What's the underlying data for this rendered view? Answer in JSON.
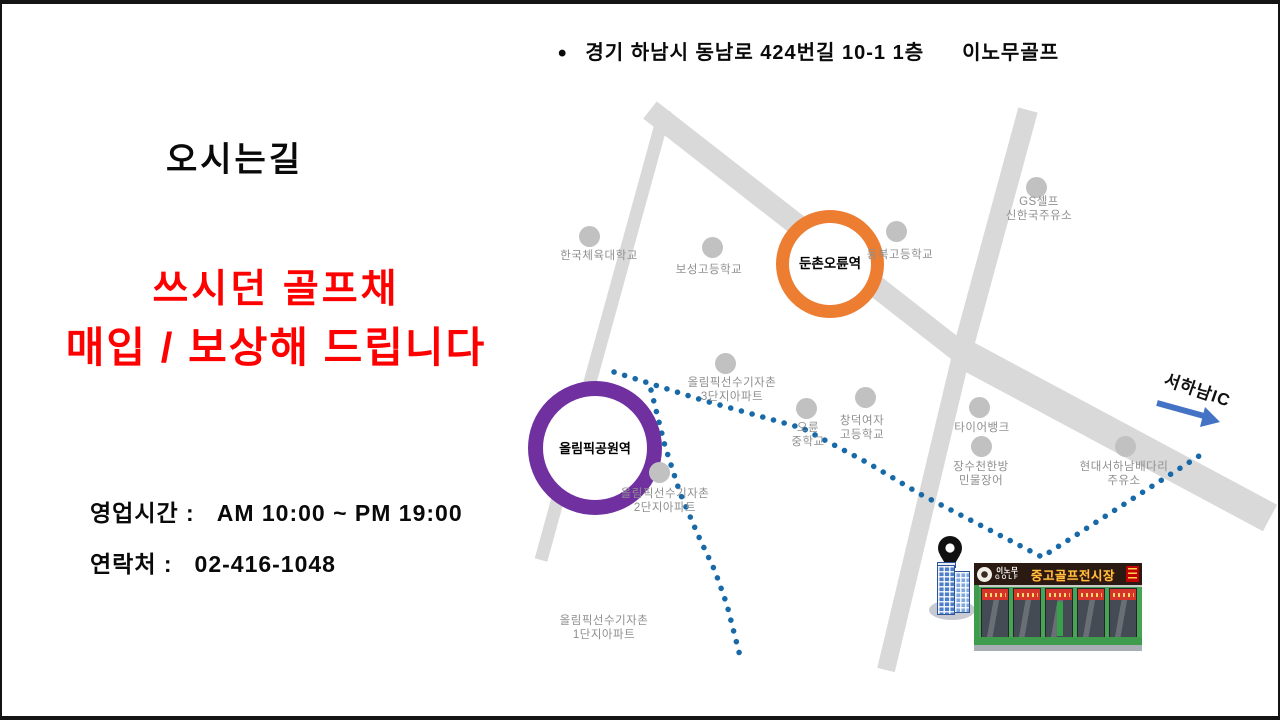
{
  "address": {
    "bullet": "•",
    "text": "경기 하남시 동남로 424번길 10-1 1층",
    "brand": "이노무골프"
  },
  "title": "오시는길",
  "promo": {
    "line1": "쓰시던 골프채",
    "line2": "매입 / 보상해 드립니다",
    "color": "#FF0000"
  },
  "info": {
    "hours_label": "영업시간 :",
    "hours_value": "AM 10:00 ~ PM 19:00",
    "contact_label": "연락처 :",
    "contact_value": "02-416-1048"
  },
  "map": {
    "road_color": "#D9D9D9",
    "route_color": "#1769A8",
    "arrow_color": "#4472C4",
    "poi_dot_color": "#C1C1C1",
    "poi_text_color": "#8F8F8F",
    "roads": [
      [
        648,
        106,
        963,
        352,
        22
      ],
      [
        958,
        348,
        1268,
        514,
        30
      ],
      [
        1026,
        106,
        958,
        356,
        20
      ],
      [
        958,
        356,
        884,
        666,
        18
      ],
      [
        663,
        106,
        539,
        556,
        13
      ]
    ],
    "routes": [
      [
        [
          612,
          368
        ],
        [
          700,
          396
        ],
        [
          800,
          424
        ],
        [
          866,
          459
        ],
        [
          918,
          490
        ],
        [
          1040,
          553
        ],
        [
          1197,
          452
        ]
      ],
      [
        [
          649,
          386
        ],
        [
          663,
          442
        ],
        [
          678,
          489
        ],
        [
          696,
          531
        ],
        [
          713,
          567
        ],
        [
          725,
          601
        ],
        [
          738,
          652
        ]
      ]
    ],
    "stations": [
      {
        "name": "둔촌오륜역",
        "x": 815,
        "y": 247,
        "size": 82,
        "stroke": 13,
        "color": "#ED7D31",
        "font": 13.5
      },
      {
        "name": "올림픽공원역",
        "x": 578,
        "y": 429,
        "size": 104,
        "stroke": 15,
        "color": "#7030A0",
        "font": 13
      }
    ],
    "pois": [
      {
        "lines": [
          "한국체육대학교"
        ],
        "dot": [
          587,
          232
        ],
        "label": [
          597,
          252
        ]
      },
      {
        "lines": [
          "보성고등학교"
        ],
        "dot": [
          710,
          243
        ],
        "label": [
          707,
          266
        ]
      },
      {
        "lines": [
          "동북고등학교"
        ],
        "dot": [
          894,
          227
        ],
        "label": [
          898,
          251
        ]
      },
      {
        "lines": [
          "GS셀프",
          "신한국주유소"
        ],
        "dot": [
          1034,
          183
        ],
        "label": [
          1037,
          205
        ]
      },
      {
        "lines": [
          "올림픽선수기자촌",
          "3단지아파트"
        ],
        "dot": [
          723,
          359
        ],
        "label": [
          730,
          386
        ]
      },
      {
        "lines": [
          "오륜",
          "중학교"
        ],
        "dot": [
          804,
          404
        ],
        "label": [
          806,
          431
        ]
      },
      {
        "lines": [
          "창덕여자",
          "고등학교"
        ],
        "dot": [
          863,
          393
        ],
        "label": [
          860,
          424
        ]
      },
      {
        "lines": [
          "올림픽선수기자촌",
          "2단지아파트"
        ],
        "dot": [
          657,
          468
        ],
        "label": [
          663,
          497
        ]
      },
      {
        "lines": [
          "타이어뱅크"
        ],
        "dot": [
          977,
          403
        ],
        "label": [
          980,
          424
        ]
      },
      {
        "lines": [
          "장수천한방",
          "민물장어"
        ],
        "dot": [
          979,
          442
        ],
        "label": [
          979,
          470
        ]
      },
      {
        "lines": [
          "현대서하남배다리",
          "주유소"
        ],
        "dot": [
          1123,
          442
        ],
        "label": [
          1122,
          470
        ]
      },
      {
        "lines": [
          "올림픽선수기자촌",
          "1단지아파트"
        ],
        "dot": null,
        "label": [
          602,
          624
        ]
      }
    ],
    "highway": {
      "label": "서하남IC",
      "arrow_line": [
        1155,
        399,
        1202,
        412
      ],
      "arrow_head": "1218,418 1198,423 1203,403"
    },
    "pin": {
      "x": 948,
      "y": 544
    }
  },
  "store": {
    "sign_brand_top": "이노무",
    "sign_brand_bottom": "GOLF",
    "sign_title": "중고골프전시장",
    "sign_bg": "#2B1A12",
    "sign_title_color": "#FFC43B"
  }
}
